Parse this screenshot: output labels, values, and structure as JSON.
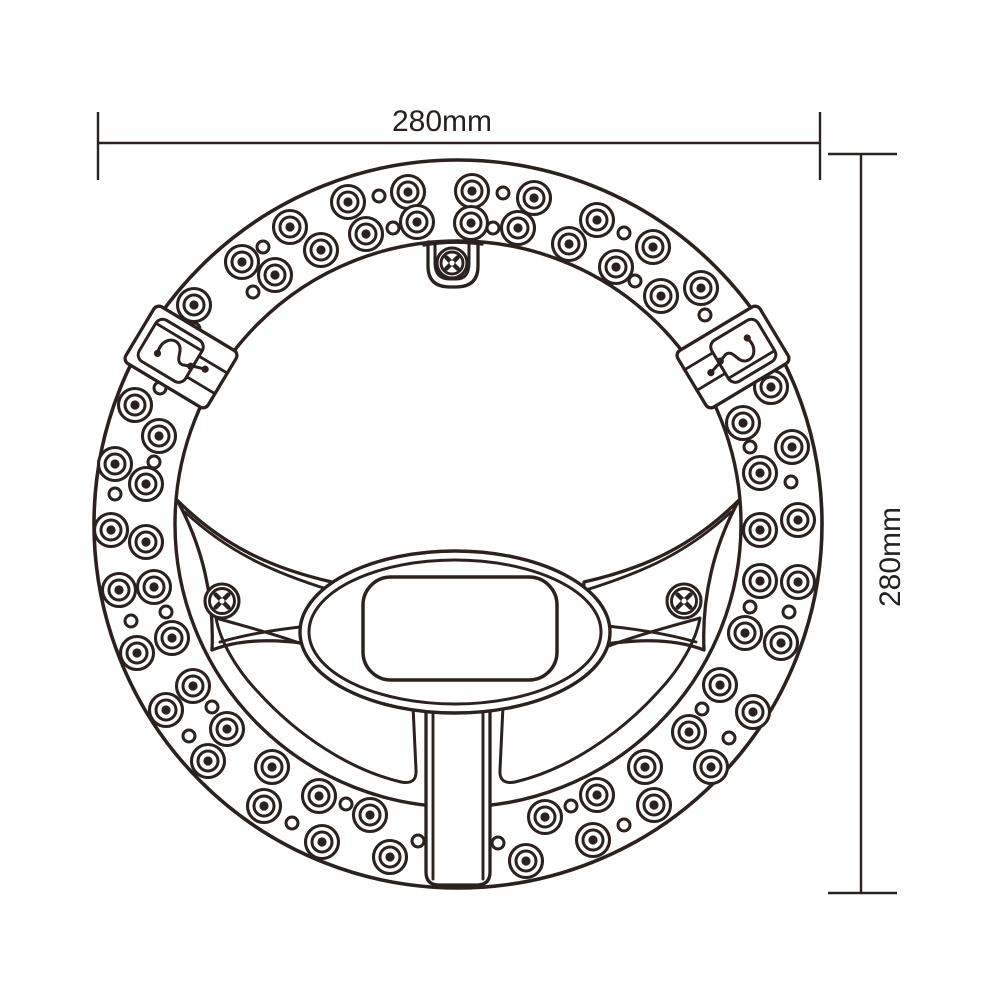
{
  "dimensions": {
    "width_label": "280mm",
    "height_label": "280mm"
  },
  "palette": {
    "line": "#2b2220",
    "background": "#ffffff"
  },
  "ring": {
    "cx": 458,
    "cy": 524,
    "outer_r": 364,
    "inner_r": 283,
    "led_count": 59,
    "hole_count": 29
  },
  "leds_outer": [
    [
      348,
      202
    ],
    [
      408,
      192
    ],
    [
      472,
      191
    ],
    [
      534,
      198
    ],
    [
      597,
      220
    ],
    [
      653,
      247
    ],
    [
      701,
      288
    ],
    [
      771,
      387
    ],
    [
      792,
      447
    ],
    [
      798,
      520
    ],
    [
      798,
      582
    ],
    [
      781,
      643
    ],
    [
      753,
      712
    ],
    [
      711,
      767
    ],
    [
      654,
      805
    ],
    [
      593,
      840
    ],
    [
      526,
      861
    ],
    [
      390,
      857
    ],
    [
      322,
      842
    ],
    [
      264,
      806
    ],
    [
      208,
      761
    ],
    [
      166,
      710
    ],
    [
      137,
      653
    ],
    [
      119,
      590
    ],
    [
      111,
      530
    ],
    [
      115,
      464
    ],
    [
      135,
      405
    ],
    [
      194,
      305
    ],
    [
      242,
      262
    ],
    [
      290,
      227
    ]
  ],
  "leds_inner": [
    [
      366,
      234
    ],
    [
      417,
      222
    ],
    [
      471,
      223
    ],
    [
      518,
      228
    ],
    [
      569,
      244
    ],
    [
      616,
      267
    ],
    [
      661,
      296
    ],
    [
      743,
      423
    ],
    [
      760,
      473
    ],
    [
      760,
      530
    ],
    [
      760,
      581
    ],
    [
      745,
      633
    ],
    [
      720,
      685
    ],
    [
      689,
      732
    ],
    [
      645,
      767
    ],
    [
      597,
      795
    ],
    [
      545,
      817
    ],
    [
      370,
      815
    ],
    [
      319,
      796
    ],
    [
      272,
      767
    ],
    [
      227,
      729
    ],
    [
      193,
      686
    ],
    [
      172,
      638
    ],
    [
      154,
      587
    ],
    [
      146,
      542
    ],
    [
      146,
      484
    ],
    [
      159,
      436
    ],
    [
      275,
      275
    ],
    [
      321,
      250
    ]
  ],
  "holes": [
    [
      379,
      196
    ],
    [
      503,
      193
    ],
    [
      263,
      247
    ],
    [
      624,
      233
    ],
    [
      393,
      228
    ],
    [
      493,
      228
    ],
    [
      635,
      281
    ],
    [
      705,
      315
    ],
    [
      253,
      292
    ],
    [
      194,
      329
    ],
    [
      160,
      388
    ],
    [
      750,
      447
    ],
    [
      791,
      482
    ],
    [
      154,
      462
    ],
    [
      115,
      494
    ],
    [
      131,
      621
    ],
    [
      166,
      612
    ],
    [
      750,
      607
    ],
    [
      789,
      612
    ],
    [
      212,
      707
    ],
    [
      189,
      736
    ],
    [
      702,
      709
    ],
    [
      729,
      738
    ],
    [
      292,
      823
    ],
    [
      346,
      804
    ],
    [
      418,
      841
    ],
    [
      498,
      843
    ],
    [
      571,
      806
    ],
    [
      624,
      825
    ]
  ],
  "bracket_screws": [
    {
      "cx": 222,
      "cy": 601
    },
    {
      "cx": 684,
      "cy": 601
    }
  ],
  "tab_screw": {
    "cx": 452,
    "cy": 263
  },
  "clips": [
    {
      "cx": 181,
      "cy": 357,
      "rotate": -59
    },
    {
      "cx": 733,
      "cy": 357,
      "rotate": 59
    }
  ],
  "center": {
    "ellipse": {
      "cx": 455,
      "cy": 632,
      "rx": 155,
      "ry": 81,
      "inner_rx": 146,
      "inner_ry": 72
    },
    "window": {
      "x": 363,
      "y": 577,
      "w": 194,
      "h": 103,
      "r": 28
    },
    "stem": {
      "x1": 426,
      "x2": 490,
      "top": 695,
      "bottom": 885,
      "corner": 13
    }
  },
  "dim_top": {
    "y": 143,
    "x1": 98,
    "x2": 820,
    "tick_y1": 112,
    "tick_y2": 180,
    "label_x": 442,
    "label_y": 131
  },
  "dim_right": {
    "x": 861,
    "y1": 154,
    "y2": 893,
    "tick_x1": 828,
    "tick_x2": 897,
    "label_x": 900,
    "label_y": 557
  }
}
